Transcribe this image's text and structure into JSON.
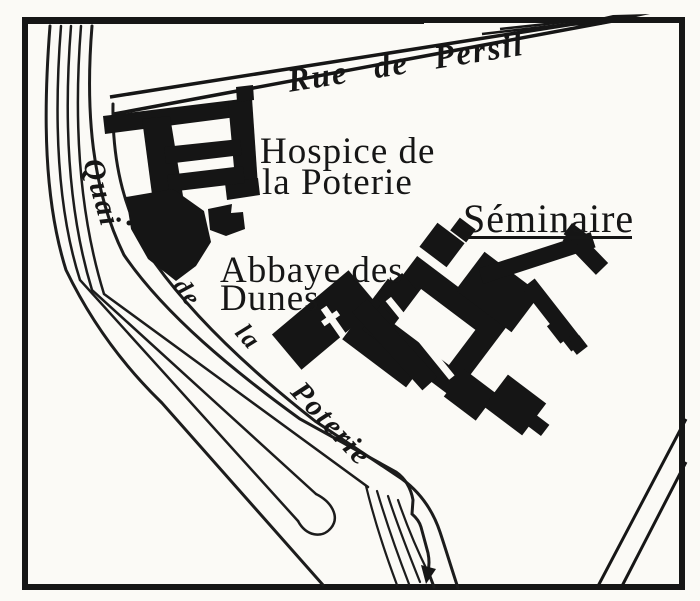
{
  "map": {
    "colors": {
      "ink": "#161616",
      "paper": "#fbfaf6"
    },
    "streets": {
      "rue_de_persil": {
        "word1": "Rue",
        "word2": "de",
        "word3": "Persil"
      },
      "quai": {
        "word1": "Quai",
        "word2": "de",
        "word3": "la",
        "word4": "Poterie"
      }
    },
    "buildings": {
      "hospice": {
        "line1": "Hospice de",
        "line2": "la Poterie"
      },
      "seminaire": {
        "label": "Séminaire"
      },
      "abbaye": {
        "line1": "Abbaye des",
        "line2": "Dunes"
      }
    },
    "icons": {
      "church_cross": "white-cross-marker",
      "flow_arrow": "down-arrowhead"
    }
  }
}
